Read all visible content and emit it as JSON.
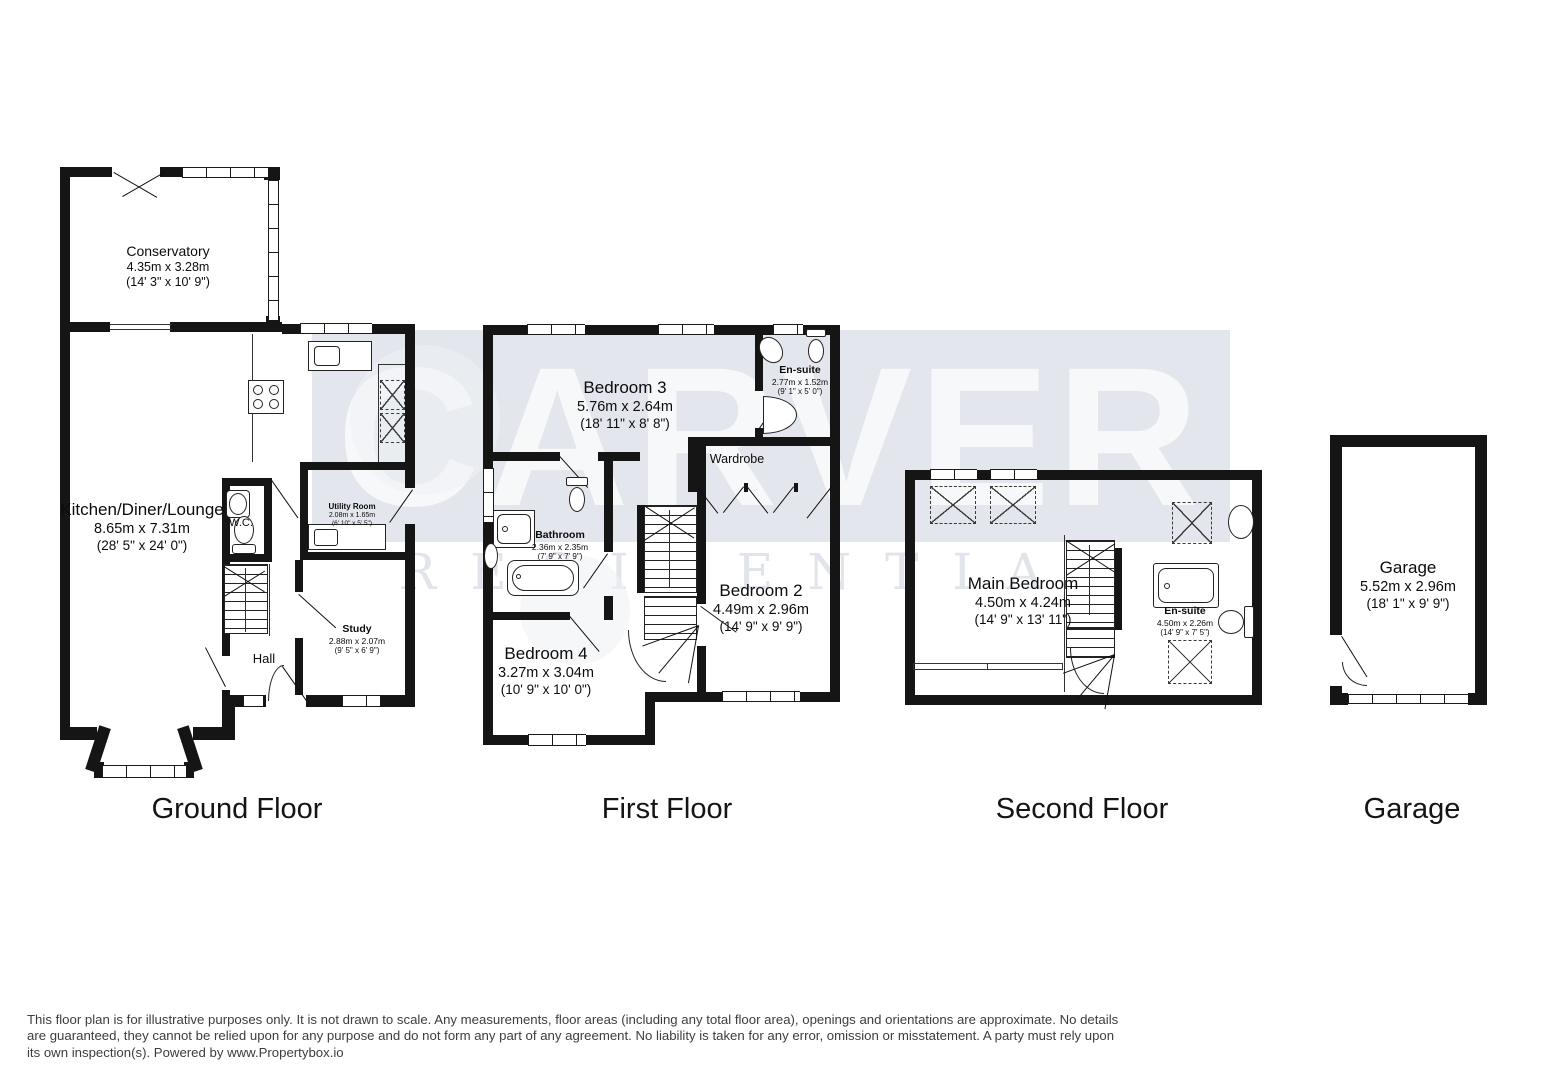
{
  "watermark": {
    "primary": "CARVER",
    "secondary": "RESIDENTIAL"
  },
  "floors": [
    {
      "title": "Ground Floor",
      "rooms": {
        "conservatory": {
          "name": "Conservatory",
          "metric": "4.35m x 3.28m",
          "imperial": "(14' 3\" x 10' 9\")"
        },
        "kitchen": {
          "name": "Kitchen/Diner/Lounge",
          "metric": "8.65m x 7.31m",
          "imperial": "(28' 5\" x 24' 0\")"
        },
        "wc": {
          "name": "W.C."
        },
        "utility": {
          "name": "Utility Room",
          "metric": "2.08m x 1.65m",
          "imperial": "(6' 10\" x 5' 5\")"
        },
        "study": {
          "name": "Study",
          "metric": "2.88m x 2.07m",
          "imperial": "(9' 5\" x 6' 9\")"
        },
        "hall": {
          "name": "Hall"
        }
      }
    },
    {
      "title": "First Floor",
      "rooms": {
        "bedroom3": {
          "name": "Bedroom 3",
          "metric": "5.76m x 2.64m",
          "imperial": "(18' 11\" x 8' 8\")"
        },
        "ensuite": {
          "name": "En-suite",
          "metric": "2.77m x 1.52m",
          "imperial": "(9' 1\" x 5' 0\")"
        },
        "wardrobe": {
          "name": "Wardrobe"
        },
        "bathroom": {
          "name": "Bathroom",
          "metric": "2.36m x 2.35m",
          "imperial": "(7' 9\" x 7' 9\")"
        },
        "bedroom2": {
          "name": "Bedroom 2",
          "metric": "4.49m x 2.96m",
          "imperial": "(14' 9\" x 9' 9\")"
        },
        "bedroom4": {
          "name": "Bedroom 4",
          "metric": "3.27m x 3.04m",
          "imperial": "(10' 9\" x 10' 0\")"
        }
      }
    },
    {
      "title": "Second Floor",
      "rooms": {
        "main_bedroom": {
          "name": "Main Bedroom",
          "metric": "4.50m x 4.24m",
          "imperial": "(14' 9\" x 13' 11\")"
        },
        "ensuite": {
          "name": "En-suite",
          "metric": "4.50m x 2.26m",
          "imperial": "(14' 9\" x 7' 5\")"
        }
      }
    },
    {
      "title": "Garage",
      "rooms": {
        "garage": {
          "name": "Garage",
          "metric": "5.52m x 2.96m",
          "imperial": "(18' 1\" x 9' 9\")"
        }
      }
    }
  ],
  "disclaimer": {
    "text": "This floor plan is for illustrative purposes only. It is not drawn to scale. Any measurements, floor areas (including any total floor area), openings and orientations are approximate. No details are guaranteed, they cannot be relied upon for any purpose and do not form any part of any agreement. No liability is taken for any error, omission or misstatement. A party must rely upon its own inspection(s). Powered by www.Propertybox.io"
  }
}
